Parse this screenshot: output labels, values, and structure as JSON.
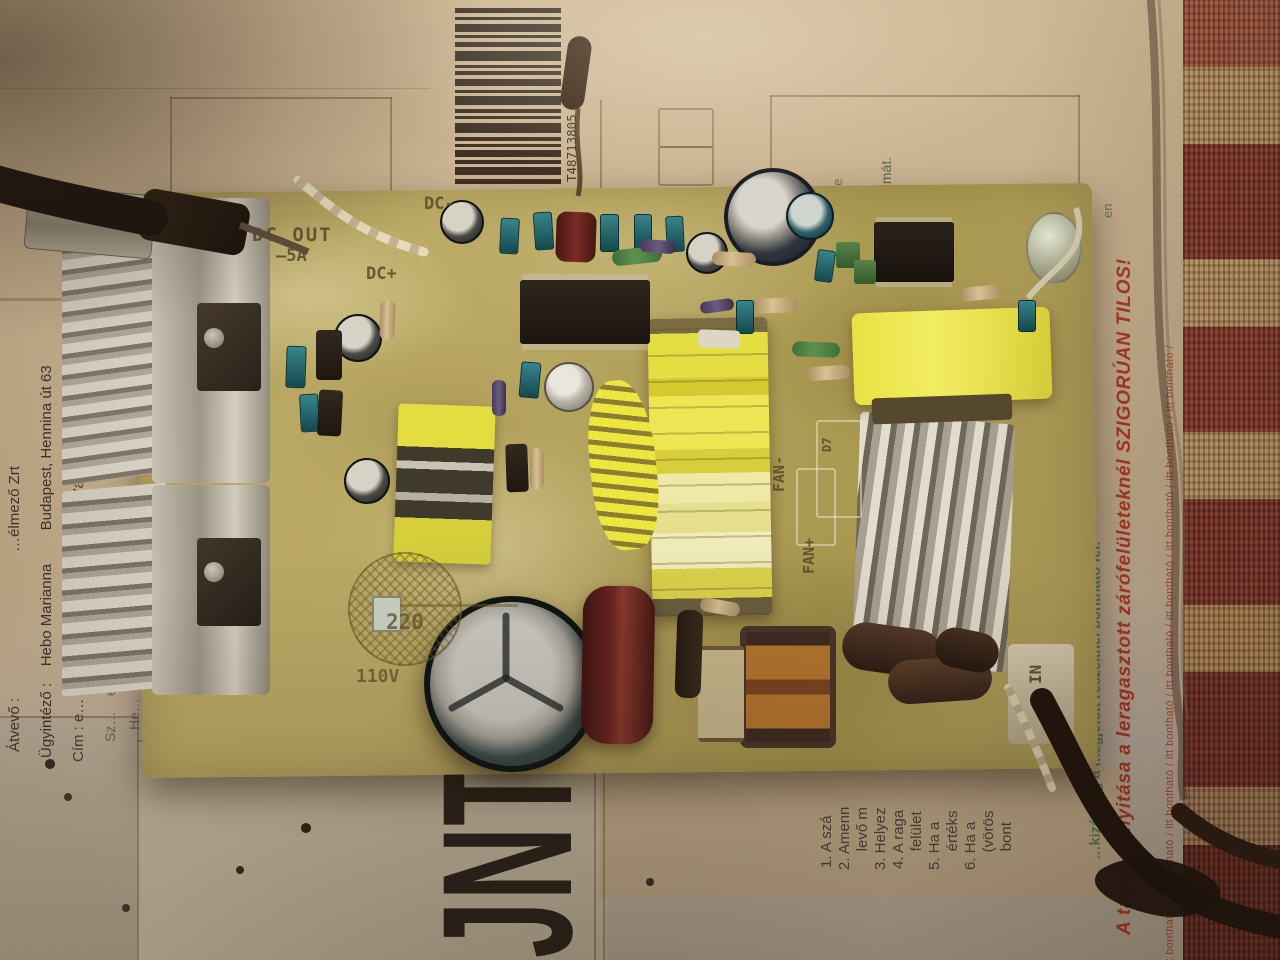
{
  "bag": {
    "barcode_number": "T48713805",
    "address": {
      "line1": "Átvevő :                                   …élmező Zrt",
      "line2": "Ügyintéző :    Hebo Marianna        Budapest, Hennina út 63",
      "line3": "Cím : e…     0646470101     Juha dán · Várkoly M…nna",
      "line4": "Sz…    ed     d      Ok",
      "line5": "He…"
    },
    "instructions": [
      "1. A szá",
      "2. Amenn",
      "    levő m",
      "3. Helyez",
      "4. A raga",
      "    felület",
      "5. Ha a",
      "    értéks",
      "6. Ha a",
      "    (vörös",
      "    bont"
    ],
    "green_note_1": "…k, jegyzőkönyvileg …z é…",
    "green_note_2": "…ki …ldeményt.",
    "green_note_3": "…kizárólag a megjelölt részeknél bontható fel.",
    "red_warning": "A tasak felnyitása a leragasztott zárófelületeknél SZIGORÚAN TILOS!",
    "edge_text": "itt bontható / itt bontható / itt bontható / itt bontható / itt bontható / itt bontható / itt bontható / itt bontható / itt bontható /",
    "fragment_1": "itte",
    "fragment_2": "almát.",
    "fragment_3": "en",
    "big_letters": "JNT"
  },
  "board": {
    "silkscreen": {
      "dc_minus": "DC-",
      "dc_out": "DC OUT",
      "dc_amps": "–5A",
      "dc_plus": "DC+",
      "sel_220": "220",
      "sel_110": "110V",
      "fan_minus": "FAN-",
      "fan_plus": "FAN+",
      "d7": "D7",
      "in_label": "IN"
    }
  },
  "colors": {
    "bag": "#c7b190",
    "board": "#b2a15c",
    "transformer_yellow": "#e8e142",
    "fabric_red": "#8c3b2d",
    "warning_red": "#b03826",
    "note_green": "#4a7a3a"
  }
}
